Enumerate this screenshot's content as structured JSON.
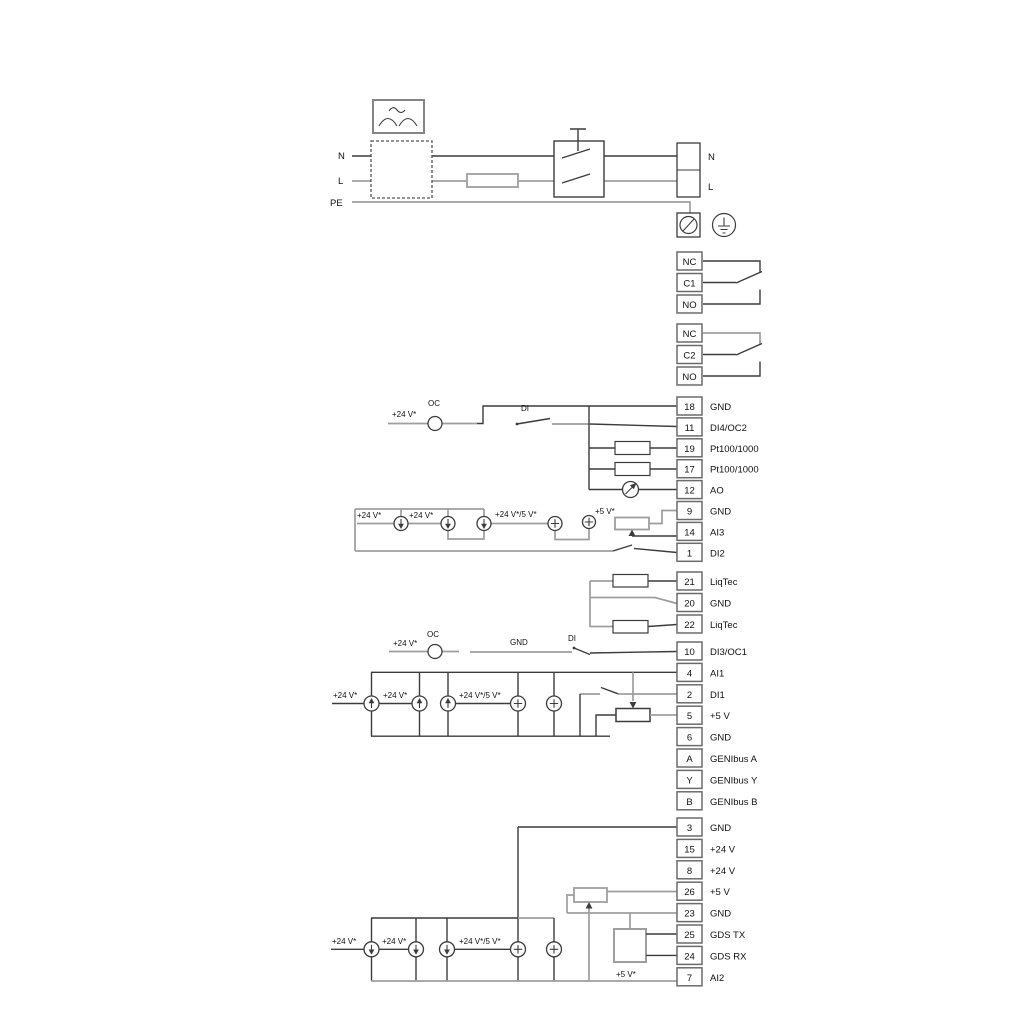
{
  "colors": {
    "wire_dark": "#3c3c3c",
    "wire_light": "#9e9e9e",
    "terminal_border": "#6b6b6b",
    "background": "#ffffff"
  },
  "labels": {
    "n": "N",
    "l": "L",
    "pe": "PE",
    "plus24": "+24 V*",
    "plus24or5": "+24 V*/5 V*",
    "plus5": "+5 V*",
    "oc": "OC",
    "di": "DI",
    "gnd": "GND"
  },
  "terminal_groups": [
    {
      "name": "relay-1",
      "top": 252,
      "pitch": 21.5,
      "cells": [
        {
          "t": "NC",
          "label": ""
        },
        {
          "t": "C1",
          "label": ""
        },
        {
          "t": "NO",
          "label": ""
        }
      ]
    },
    {
      "name": "relay-2",
      "top": 324,
      "pitch": 21.5,
      "cells": [
        {
          "t": "NC",
          "label": ""
        },
        {
          "t": "C2",
          "label": ""
        },
        {
          "t": "NO",
          "label": ""
        }
      ]
    },
    {
      "name": "io-upper",
      "top": 397,
      "pitch": 20.9,
      "cells": [
        {
          "t": "18",
          "label": "GND"
        },
        {
          "t": "11",
          "label": "DI4/OC2"
        },
        {
          "t": "19",
          "label": "Pt100/1000"
        },
        {
          "t": "17",
          "label": "Pt100/1000"
        },
        {
          "t": "12",
          "label": "AO"
        },
        {
          "t": "9",
          "label": "GND"
        },
        {
          "t": "14",
          "label": "AI3"
        },
        {
          "t": "1",
          "label": "DI2"
        }
      ]
    },
    {
      "name": "liqtec",
      "top": 572,
      "pitch": 21.5,
      "cells": [
        {
          "t": "21",
          "label": "LiqTec"
        },
        {
          "t": "20",
          "label": "GND"
        },
        {
          "t": "22",
          "label": "LiqTec"
        }
      ]
    },
    {
      "name": "io-mid",
      "top": 642,
      "pitch": 21.4,
      "cells": [
        {
          "t": "10",
          "label": "DI3/OC1"
        },
        {
          "t": "4",
          "label": "AI1"
        },
        {
          "t": "2",
          "label": "DI1"
        },
        {
          "t": "5",
          "label": "+5 V"
        },
        {
          "t": "6",
          "label": "GND"
        },
        {
          "t": "A",
          "label": "GENIbus A"
        },
        {
          "t": "Y",
          "label": "GENIbus Y"
        },
        {
          "t": "B",
          "label": "GENIbus B"
        }
      ]
    },
    {
      "name": "io-lower",
      "top": 818,
      "pitch": 21.4,
      "cells": [
        {
          "t": "3",
          "label": "GND"
        },
        {
          "t": "15",
          "label": "+24 V"
        },
        {
          "t": "8",
          "label": "+24 V"
        },
        {
          "t": "26",
          "label": "+5 V"
        },
        {
          "t": "23",
          "label": "GND"
        },
        {
          "t": "25",
          "label": "GDS TX"
        },
        {
          "t": "24",
          "label": "GDS RX"
        },
        {
          "t": "7",
          "label": "AI2"
        }
      ]
    }
  ]
}
